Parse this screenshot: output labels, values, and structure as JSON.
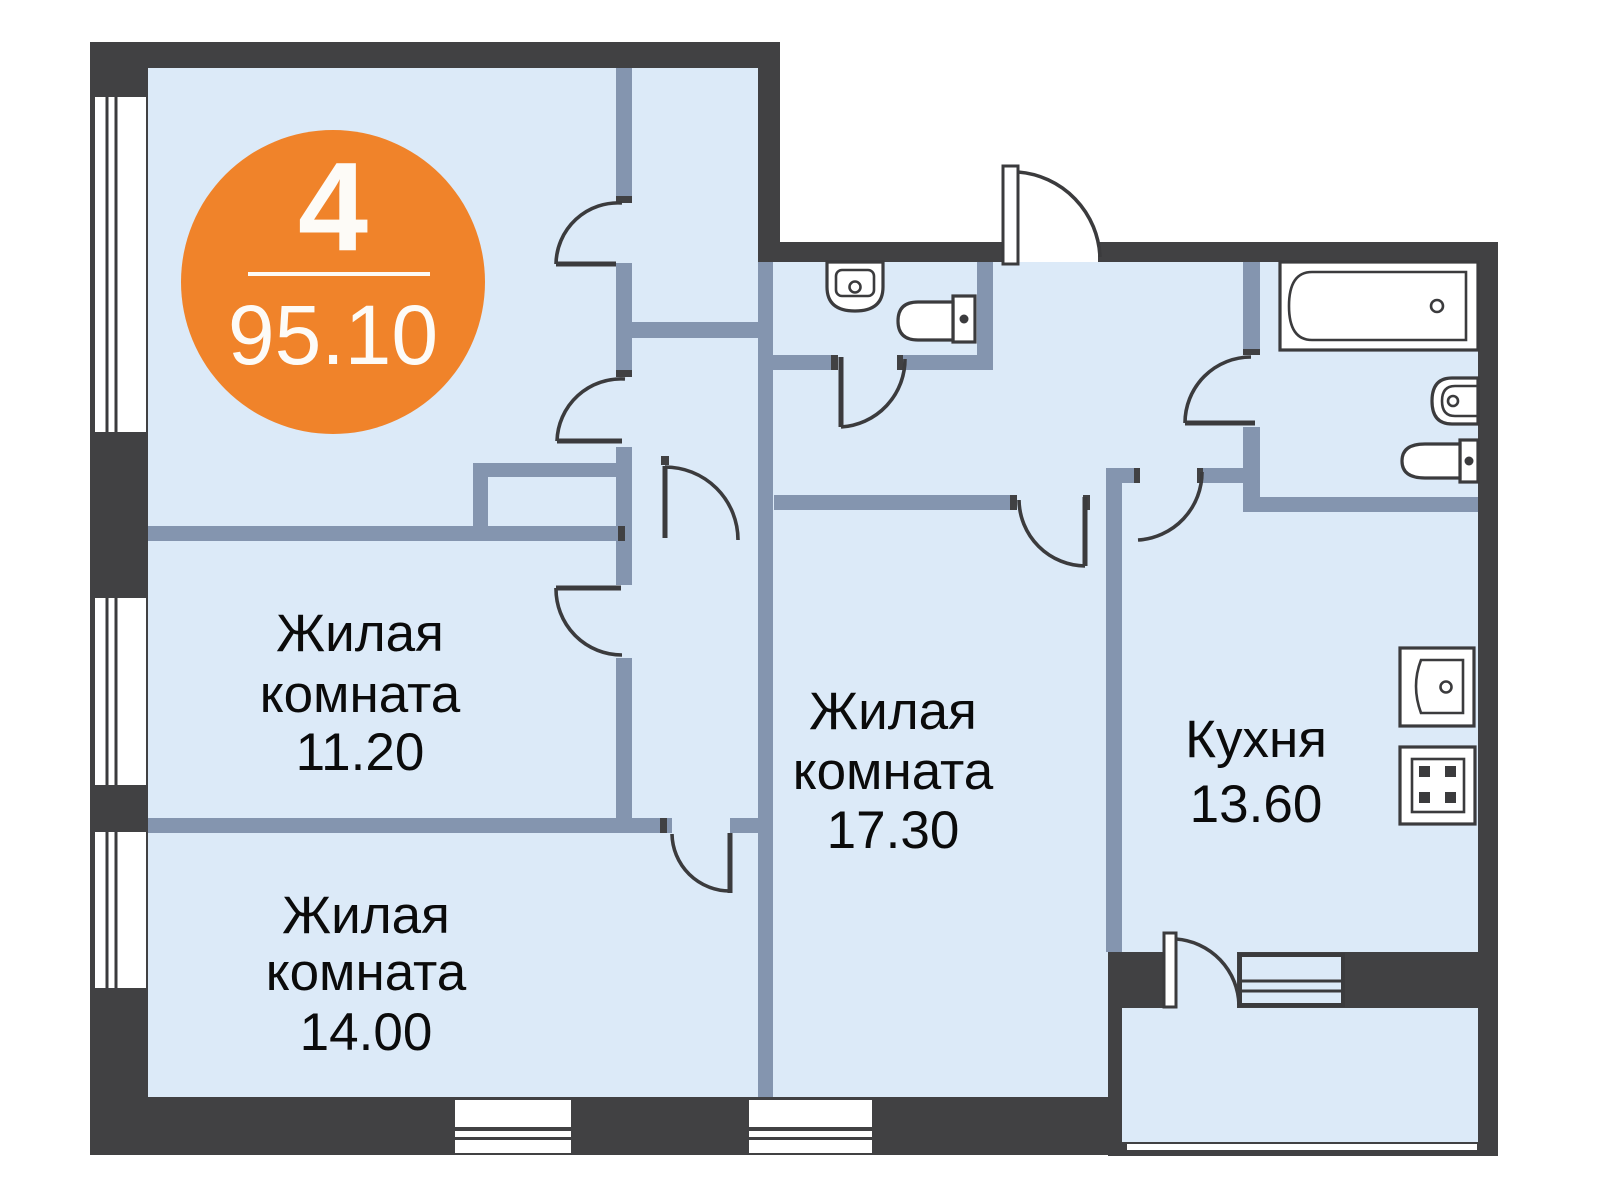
{
  "plan_title": "4-room apartment floor plan",
  "badge": {
    "rooms_count": "4",
    "total_area": "95.10",
    "color": "#F0832A"
  },
  "rooms": [
    {
      "id": "living-room-1",
      "line1": "Жилая",
      "line2": "комната",
      "area": "11.20"
    },
    {
      "id": "living-room-2",
      "line1": "Жилая",
      "line2": "комната",
      "area": "14.00"
    },
    {
      "id": "living-room-3",
      "line1": "Жилая",
      "line2": "комната",
      "area": "17.30"
    },
    {
      "id": "kitchen",
      "line1": "Кухня",
      "area": "13.60"
    }
  ],
  "fixtures": [
    "bathtub",
    "bathroom-sink",
    "bathroom-toilet",
    "wc-sink",
    "wc-toilet",
    "kitchen-sink",
    "kitchen-stove"
  ],
  "features": [
    "entrance-door",
    "balcony",
    "windows"
  ],
  "colors": {
    "outer_wall": "#414143",
    "inner_wall": "#8495AF",
    "floor": "#DCEAF8",
    "accent": "#F0832A"
  }
}
